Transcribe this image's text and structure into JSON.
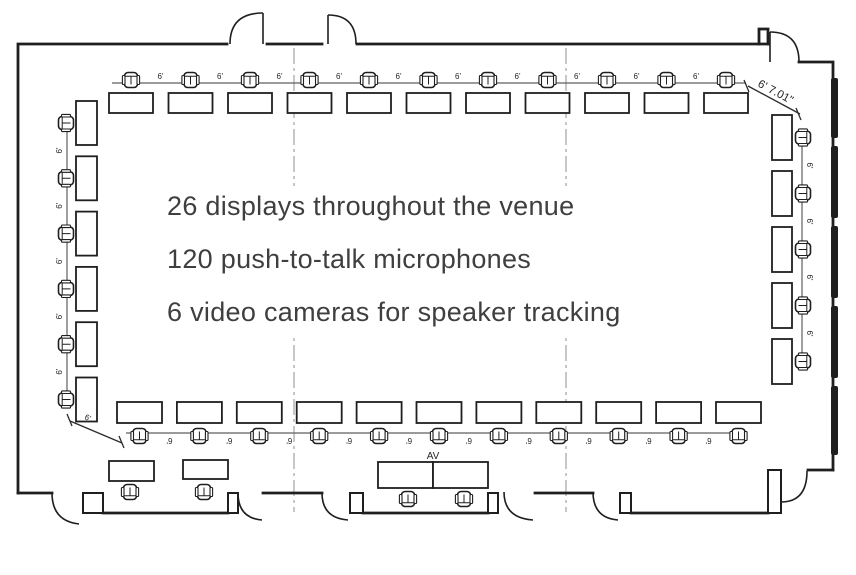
{
  "annotations": {
    "line1": "26 displays throughout the venue",
    "line2": "120 push-to-talk microphones",
    "line3": "6 video cameras for speaker tracking"
  },
  "labels": {
    "spacing": "6'",
    "corner_top_right": "6' 7.01\"",
    "corner_bottom_left": "6'",
    "av": "AV"
  },
  "colors": {
    "ink": "#1f1f1f",
    "thin_line": "#5f5f5f",
    "centerline": "#8f8f8f",
    "annotation_text": "#3f3f3f"
  },
  "floorplan": {
    "rows": [
      {
        "name": "top-row",
        "dir": "h",
        "count": 11,
        "start": 109,
        "step": 59.5,
        "tableCross": 93,
        "tableLen": 44,
        "tableDepth": 20,
        "chairCross": 80,
        "chairRot": 0,
        "labelCount": 10,
        "labelStart": 160.5,
        "labelCross": 79,
        "labelRot": 0
      },
      {
        "name": "bottom-row",
        "dir": "h",
        "count": 11,
        "start": 117,
        "step": 59.9,
        "tableCross": 402,
        "tableLen": 45,
        "tableDepth": 21,
        "chairCross": 436,
        "chairRot": 180,
        "labelCount": 10,
        "labelStart": 169.5,
        "labelCross": 438,
        "labelRot": 180
      },
      {
        "name": "left-column",
        "dir": "v",
        "count": 6,
        "start": 101,
        "step": 55.3,
        "tableCross": 76,
        "tableLen": 44,
        "tableDepth": 21,
        "chairCross": 66,
        "chairRot": -90,
        "labelCount": 5,
        "labelStart": 150.5,
        "labelCross": 62,
        "labelRot": -90
      },
      {
        "name": "right-column",
        "dir": "v",
        "count": 5,
        "start": 115,
        "step": 56,
        "tableCross": 772,
        "tableLen": 45,
        "tableDepth": 20,
        "chairCross": 803,
        "chairRot": 90,
        "labelCount": 4,
        "labelStart": 165.5,
        "labelCross": 807,
        "labelRot": 90
      }
    ],
    "extra_tables": [
      {
        "x": 109,
        "y": 461,
        "w": 45,
        "h": 20
      },
      {
        "x": 183,
        "y": 460,
        "w": 45,
        "h": 19
      },
      {
        "x": 378,
        "y": 462,
        "w": 55,
        "h": 26
      },
      {
        "x": 433,
        "y": 462,
        "w": 55,
        "h": 26
      }
    ],
    "extra_chairs": [
      {
        "x": 130,
        "y": 492,
        "rot": 180
      },
      {
        "x": 204,
        "y": 492,
        "rot": 180
      },
      {
        "x": 408,
        "y": 499,
        "rot": 180
      },
      {
        "x": 464,
        "y": 499,
        "rot": 180
      }
    ]
  }
}
